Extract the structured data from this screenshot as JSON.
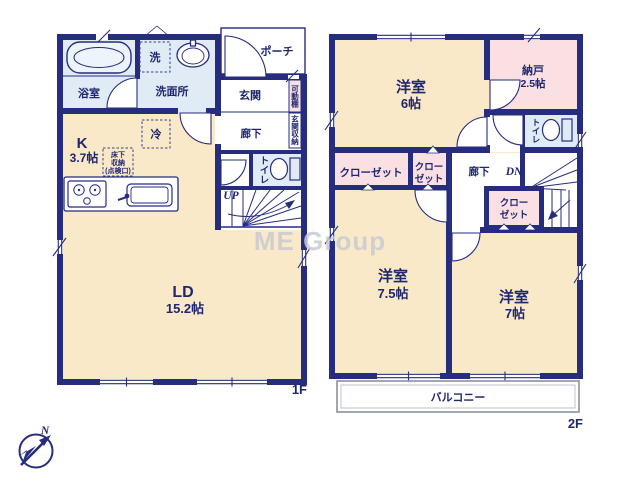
{
  "f1": {
    "label": "1F",
    "bath": "浴室",
    "wash": "洗面所",
    "entrance": "玄関",
    "porch": "ポーチ",
    "hall": "廊下",
    "toilet": "トイレ",
    "k": "K",
    "k_size": "3.7帖",
    "ld": "LD",
    "ld_size": "15.2帖",
    "washer": "洗",
    "fridge": "冷",
    "uf1": "床下",
    "uf2": "収納",
    "uf3": "(点検口)",
    "shelf": "可動棚",
    "storage": "玄関収納",
    "up": "UP"
  },
  "f2": {
    "label": "2F",
    "w1": "洋室",
    "w1_size": "6帖",
    "nando": "納戸",
    "nando_size": "2.5帖",
    "toilet": "トイレ",
    "closet1": "クローゼット",
    "c2a": "クロー",
    "c2b": "ゼット",
    "c3a": "クロー",
    "c3b": "ゼット",
    "hall": "廊下",
    "dn": "DN",
    "w2": "洋室",
    "w2_size": "7.5帖",
    "w3": "洋室",
    "w3_size": "7帖",
    "balcony": "バルコニー"
  },
  "watermark": "ME Group",
  "compass": {
    "north": "N"
  },
  "colors": {
    "wall": "#262c7e",
    "room_cream": "#f9e9c8",
    "room_pink": "#fadfe3",
    "room_blue": "#e0ebf6",
    "balcony_line": "#8b90a0",
    "watermark": "#c8cbd2"
  }
}
